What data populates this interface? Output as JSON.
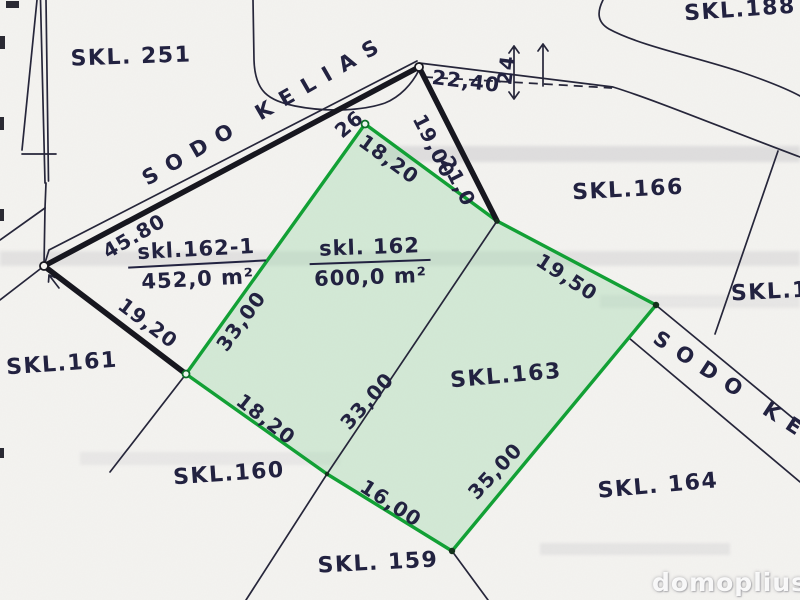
{
  "map": {
    "title": "Cadastral plan scan (sklypų planas)",
    "watermark": "domoplius.lt",
    "colors": {
      "ink": "#222240",
      "thick": "#17171f",
      "line": "#26263a",
      "green": "#12a035",
      "green_fill": "rgba(157,216,170,0.38)",
      "paper": "#f4f3f0",
      "band": "rgba(148,150,158,0.22)"
    },
    "roads": [
      {
        "id": "road-top",
        "name": "SODO KELIAS"
      },
      {
        "id": "road-right",
        "name": "SODO KELIAS"
      }
    ],
    "areas": [
      {
        "id": "162-1",
        "label": "skl.162-1",
        "area": "452,0 m²"
      },
      {
        "id": "162",
        "label": "skl. 162",
        "area": "600,0 m²"
      }
    ],
    "plot_labels": [
      {
        "id": "251",
        "label": "SKL. 251",
        "x": 131,
        "y": 57,
        "rot": -2
      },
      {
        "id": "188",
        "label": "SKL.188",
        "x": 740,
        "y": 10,
        "rot": -4
      },
      {
        "id": "166",
        "label": "SKL.166",
        "x": 628,
        "y": 190,
        "rot": -3
      },
      {
        "id": "161",
        "label": "SKL.161",
        "x": 62,
        "y": 364,
        "rot": -4
      },
      {
        "id": "160",
        "label": "SKL.160",
        "x": 229,
        "y": 474,
        "rot": -4
      },
      {
        "id": "159",
        "label": "SKL. 159",
        "x": 378,
        "y": 563,
        "rot": -3
      },
      {
        "id": "164",
        "label": "SKL. 164",
        "x": 658,
        "y": 486,
        "rot": -5
      },
      {
        "id": "163",
        "label": "SKL.163",
        "x": 506,
        "y": 376,
        "rot": -5
      },
      {
        "id": "1xx",
        "label": "SKL.1",
        "x": 770,
        "y": 292,
        "rot": -3
      }
    ],
    "measurements": [
      {
        "edge": "road-frontage",
        "value": "45.80",
        "x": 134,
        "y": 236,
        "rot": -30
      },
      {
        "edge": "side-west",
        "value": "19,20",
        "x": 148,
        "y": 323,
        "rot": 37
      },
      {
        "edge": "dashed-line",
        "value": "22,40",
        "x": 466,
        "y": 81,
        "rot": 7
      },
      {
        "edge": "road-width-tick",
        "value": "24",
        "x": 506,
        "y": 70,
        "rot": -83
      },
      {
        "edge": "road-segment-a",
        "value": "19,00",
        "x": 434,
        "y": 146,
        "rot": 63
      },
      {
        "edge": "road-segment-b",
        "value": "21,0",
        "x": 458,
        "y": 181,
        "rot": 63
      },
      {
        "edge": "corner-point",
        "value": "26",
        "x": 349,
        "y": 124,
        "rot": -40
      },
      {
        "edge": "plot162-north",
        "value": "18,20",
        "x": 389,
        "y": 159,
        "rot": 36
      },
      {
        "edge": "plot162-west",
        "value": "33,00",
        "x": 241,
        "y": 321,
        "rot": -54
      },
      {
        "edge": "plot162-south",
        "value": "18,20",
        "x": 266,
        "y": 419,
        "rot": 38
      },
      {
        "edge": "plot162-division",
        "value": "33,00",
        "x": 367,
        "y": 401,
        "rot": -48
      },
      {
        "edge": "plot163-south",
        "value": "16,00",
        "x": 391,
        "y": 503,
        "rot": 33
      },
      {
        "edge": "plot163-east",
        "value": "35,00",
        "x": 495,
        "y": 471,
        "rot": -47
      },
      {
        "edge": "plot163-north",
        "value": "19,50",
        "x": 567,
        "y": 277,
        "rot": 33
      }
    ]
  }
}
